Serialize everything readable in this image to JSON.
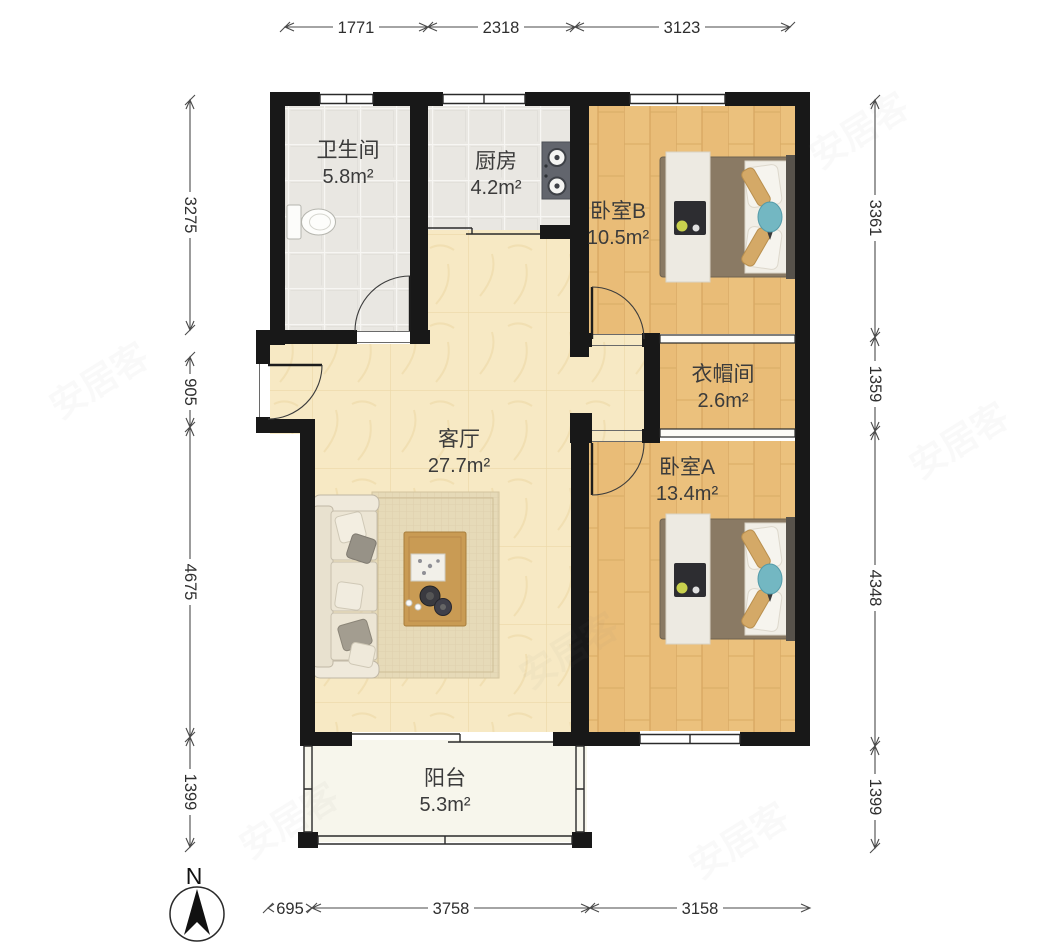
{
  "plan": {
    "rooms": [
      {
        "key": "bathroom",
        "name": "卫生间",
        "area": "5.8m²"
      },
      {
        "key": "kitchen",
        "name": "厨房",
        "area": "4.2m²"
      },
      {
        "key": "bedroom-b",
        "name": "卧室B",
        "area": "10.5m²"
      },
      {
        "key": "cloakroom",
        "name": "衣帽间",
        "area": "2.6m²"
      },
      {
        "key": "living-room",
        "name": "客厅",
        "area": "27.7m²"
      },
      {
        "key": "bedroom-a",
        "name": "卧室A",
        "area": "13.4m²"
      },
      {
        "key": "balcony",
        "name": "阳台",
        "area": "5.3m²"
      }
    ]
  },
  "dimensions": {
    "top": [
      "1771",
      "2318",
      "3123"
    ],
    "bottom": [
      "695",
      "3758",
      "3158"
    ],
    "left": [
      "3275",
      "905",
      "4675",
      "1399"
    ],
    "right": [
      "3361",
      "1359",
      "4348",
      "1399"
    ]
  },
  "compass": {
    "north_label": "N"
  },
  "watermark": {
    "text": "安居客"
  },
  "colors": {
    "wall": "#181818",
    "wood_floor": "#ebc17d",
    "tile_floor": "#e9e7e2",
    "living_floor": "#f7e9c4",
    "balcony_floor": "#f7f6ec",
    "bed_accent": "#73b7c2",
    "dimension_text": "#2e2e2e"
  }
}
